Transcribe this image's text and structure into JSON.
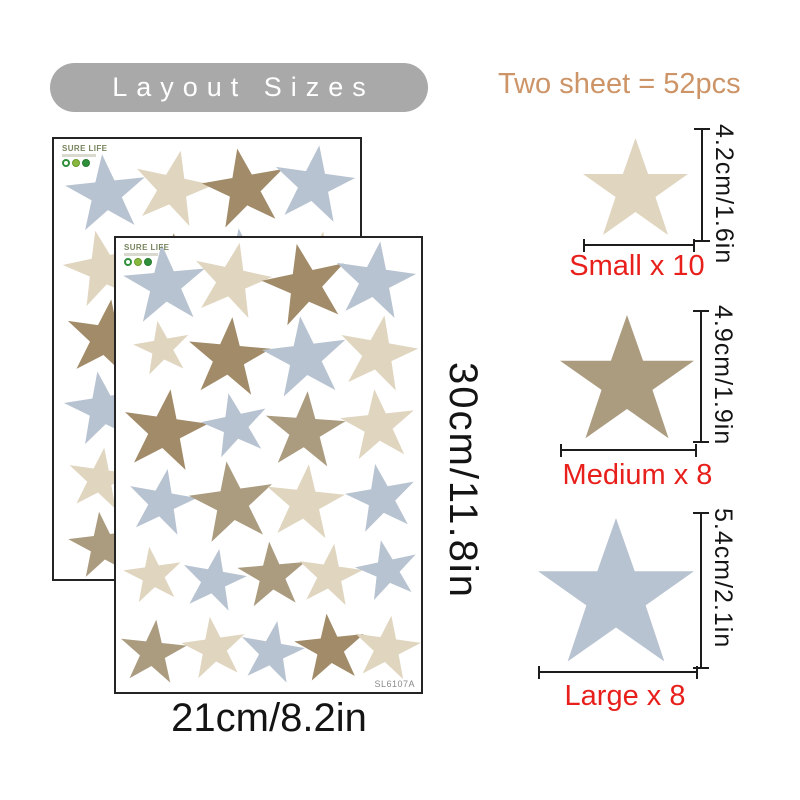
{
  "header": {
    "title": "Layout Sizes",
    "count_text": "Two sheet = 52pcs"
  },
  "colors": {
    "blue": "#b8c3d1",
    "beige": "#e0d5bf",
    "tan": "#ab9c80",
    "brown": "#a18b68",
    "red": "#e8201c",
    "line": "#1c1c1c",
    "ink": "#141414",
    "pill": "#a9a9a9",
    "count": "#cd9467",
    "code": "#8a8a8a"
  },
  "sheets": {
    "brand": "SURE LIFE",
    "code": "SL6107A",
    "width_label": "21cm/8.2in",
    "height_label": "30cm/11.8in",
    "back": {
      "stars": [
        {
          "x": 17,
          "y": 12,
          "s": 80,
          "c": "blue",
          "r": -6
        },
        {
          "x": 39,
          "y": 11,
          "s": 78,
          "c": "beige",
          "r": 12
        },
        {
          "x": 62,
          "y": 11,
          "s": 82,
          "c": "brown",
          "r": -10
        },
        {
          "x": 85,
          "y": 10,
          "s": 80,
          "c": "blue",
          "r": 8
        },
        {
          "x": 16,
          "y": 29,
          "s": 78,
          "c": "beige",
          "r": -12
        },
        {
          "x": 38,
          "y": 30,
          "s": 80,
          "c": "brown",
          "r": 6
        },
        {
          "x": 62,
          "y": 29,
          "s": 82,
          "c": "blue",
          "r": -8
        },
        {
          "x": 86,
          "y": 29,
          "s": 76,
          "c": "beige",
          "r": 10
        },
        {
          "x": 17,
          "y": 45,
          "s": 80,
          "c": "brown",
          "r": 8
        },
        {
          "x": 39,
          "y": 45,
          "s": 70,
          "c": "beige",
          "r": -8
        },
        {
          "x": 62,
          "y": 45,
          "s": 78,
          "c": "blue",
          "r": 5
        },
        {
          "x": 86,
          "y": 44,
          "s": 72,
          "c": "tan",
          "r": -10
        },
        {
          "x": 16,
          "y": 61,
          "s": 76,
          "c": "blue",
          "r": -9
        },
        {
          "x": 38,
          "y": 61,
          "s": 74,
          "c": "tan",
          "r": 7
        },
        {
          "x": 62,
          "y": 61,
          "s": 76,
          "c": "beige",
          "r": -6
        },
        {
          "x": 86,
          "y": 60,
          "s": 72,
          "c": "blue",
          "r": 10
        },
        {
          "x": 15,
          "y": 77,
          "s": 64,
          "c": "beige",
          "r": 8
        },
        {
          "x": 36,
          "y": 77,
          "s": 66,
          "c": "blue",
          "r": -10
        },
        {
          "x": 57,
          "y": 77,
          "s": 66,
          "c": "tan",
          "r": 6
        },
        {
          "x": 78,
          "y": 77,
          "s": 64,
          "c": "beige",
          "r": -8
        },
        {
          "x": 93,
          "y": 76,
          "s": 60,
          "c": "blue",
          "r": 12
        },
        {
          "x": 16,
          "y": 92,
          "s": 68,
          "c": "tan",
          "r": -7
        },
        {
          "x": 36,
          "y": 91,
          "s": 60,
          "c": "beige",
          "r": 9
        },
        {
          "x": 57,
          "y": 92,
          "s": 64,
          "c": "blue",
          "r": -5
        },
        {
          "x": 79,
          "y": 91,
          "s": 66,
          "c": "tan",
          "r": 8
        },
        {
          "x": 93,
          "y": 91,
          "s": 62,
          "c": "beige",
          "r": -10
        }
      ]
    },
    "front": {
      "stars": [
        {
          "x": 16,
          "y": 10,
          "s": 82,
          "c": "blue",
          "r": -5
        },
        {
          "x": 38,
          "y": 9,
          "s": 78,
          "c": "beige",
          "r": 12
        },
        {
          "x": 62,
          "y": 10,
          "s": 84,
          "c": "brown",
          "r": -12
        },
        {
          "x": 85,
          "y": 9,
          "s": 80,
          "c": "blue",
          "r": 8
        },
        {
          "x": 15,
          "y": 24,
          "s": 56,
          "c": "beige",
          "r": -10
        },
        {
          "x": 37,
          "y": 26,
          "s": 82,
          "c": "brown",
          "r": 5
        },
        {
          "x": 62,
          "y": 26,
          "s": 84,
          "c": "blue",
          "r": -7
        },
        {
          "x": 86,
          "y": 25,
          "s": 78,
          "c": "beige",
          "r": 10
        },
        {
          "x": 16,
          "y": 42,
          "s": 84,
          "c": "brown",
          "r": 8
        },
        {
          "x": 39,
          "y": 41,
          "s": 66,
          "c": "blue",
          "r": -12
        },
        {
          "x": 62,
          "y": 42,
          "s": 80,
          "c": "tan",
          "r": 4
        },
        {
          "x": 86,
          "y": 41,
          "s": 74,
          "c": "beige",
          "r": -6
        },
        {
          "x": 15,
          "y": 58,
          "s": 68,
          "c": "blue",
          "r": 10
        },
        {
          "x": 38,
          "y": 58,
          "s": 84,
          "c": "tan",
          "r": -8
        },
        {
          "x": 62,
          "y": 58,
          "s": 78,
          "c": "beige",
          "r": 6
        },
        {
          "x": 87,
          "y": 57,
          "s": 70,
          "c": "blue",
          "r": -10
        },
        {
          "x": 12,
          "y": 74,
          "s": 58,
          "c": "beige",
          "r": -8
        },
        {
          "x": 32,
          "y": 75,
          "s": 64,
          "c": "blue",
          "r": 10
        },
        {
          "x": 51,
          "y": 74,
          "s": 68,
          "c": "tan",
          "r": -5
        },
        {
          "x": 70,
          "y": 74,
          "s": 64,
          "c": "beige",
          "r": 8
        },
        {
          "x": 89,
          "y": 73,
          "s": 62,
          "c": "blue",
          "r": -12
        },
        {
          "x": 12,
          "y": 91,
          "s": 66,
          "c": "tan",
          "r": 6
        },
        {
          "x": 32,
          "y": 90,
          "s": 64,
          "c": "beige",
          "r": -8
        },
        {
          "x": 51,
          "y": 91,
          "s": 64,
          "c": "blue",
          "r": 10
        },
        {
          "x": 70,
          "y": 90,
          "s": 70,
          "c": "brown",
          "r": -6
        },
        {
          "x": 89,
          "y": 90,
          "s": 66,
          "c": "beige",
          "r": 8
        }
      ]
    }
  },
  "specs": [
    {
      "id": "small",
      "dim": "4.2cm/1.6in",
      "label": "Small x 10",
      "color": "beige",
      "size": 105
    },
    {
      "id": "medium",
      "dim": "4.9cm/1.9in",
      "label": "Medium x 8",
      "color": "tan",
      "size": 134
    },
    {
      "id": "large",
      "dim": "5.4cm/2.1in",
      "label": "Large x 8",
      "color": "blue",
      "size": 156
    }
  ]
}
